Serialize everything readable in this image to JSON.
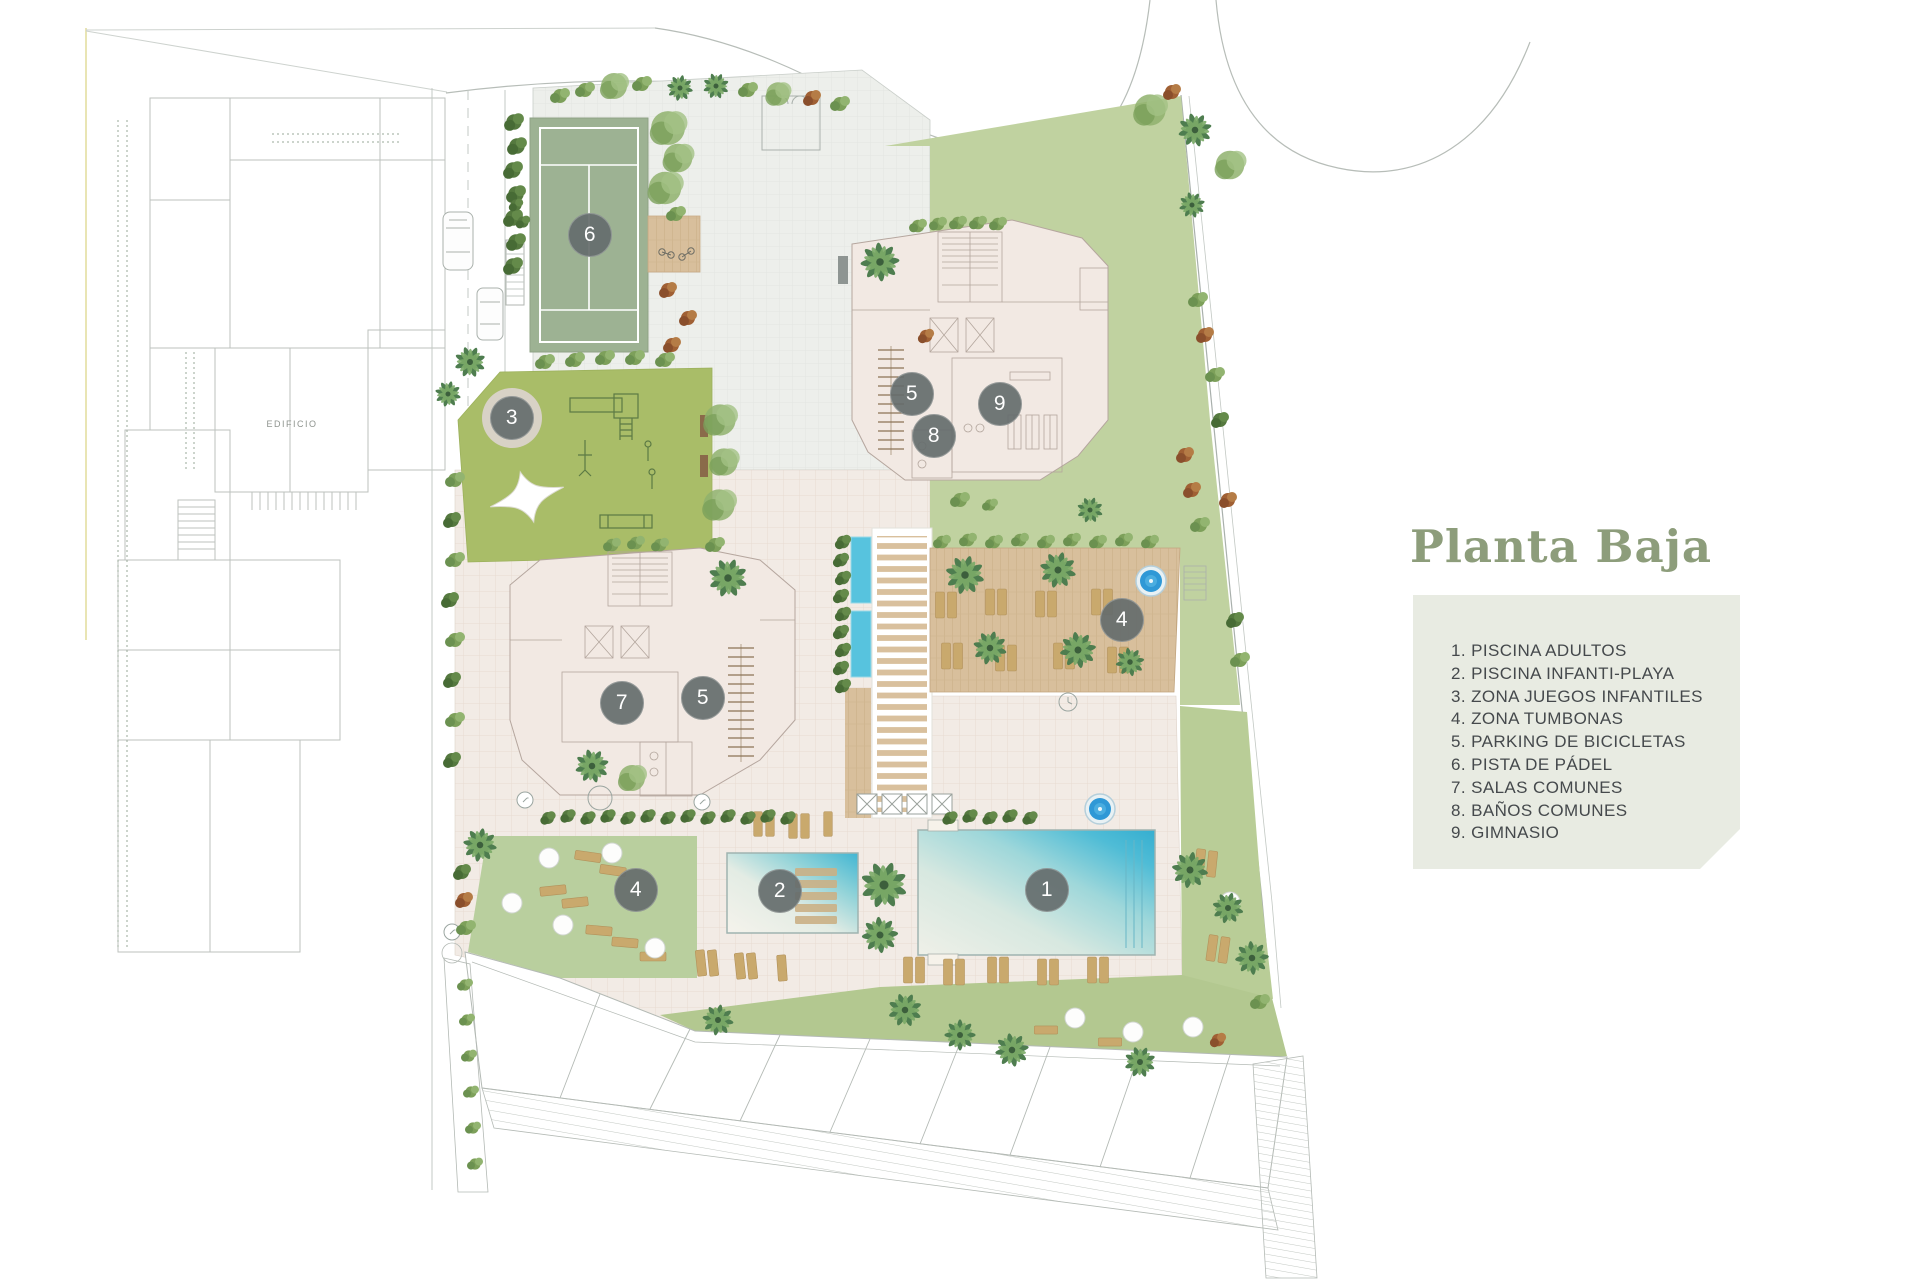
{
  "title": "Planta Baja",
  "legend": {
    "items": [
      "1. PISCINA ADULTOS",
      "2. PISCINA INFANTI-PLAYA",
      "3. ZONA JUEGOS INFANTILES",
      "4. ZONA TUMBONAS",
      "5. PARKING DE BICICLETAS",
      "6. PISTA DE PÁDEL",
      "7. SALAS COMUNES",
      "8. BAÑOS COMUNES",
      "9. GIMNASIO"
    ]
  },
  "plan": {
    "edificio_label": "EDIFICIO",
    "markers": [
      {
        "n": "6"
      },
      {
        "n": "3"
      },
      {
        "n": "5"
      },
      {
        "n": "9"
      },
      {
        "n": "8"
      },
      {
        "n": "7"
      },
      {
        "n": "5"
      },
      {
        "n": "4"
      },
      {
        "n": "4"
      },
      {
        "n": "2"
      },
      {
        "n": "1"
      }
    ]
  },
  "colors": {
    "title_green": "#8d9d7b",
    "legend_bg": "#e8ebe2",
    "legend_text": "#45494c",
    "marker_bg": "#656d6c",
    "pool_turquoise": "#3eb5d3",
    "grass_green": "#bccf9f",
    "playground_green": "#a9bd68",
    "padel_green": "#9db293",
    "deck_wood": "#d8bf9c",
    "building_fill": "#f2e9e3"
  }
}
